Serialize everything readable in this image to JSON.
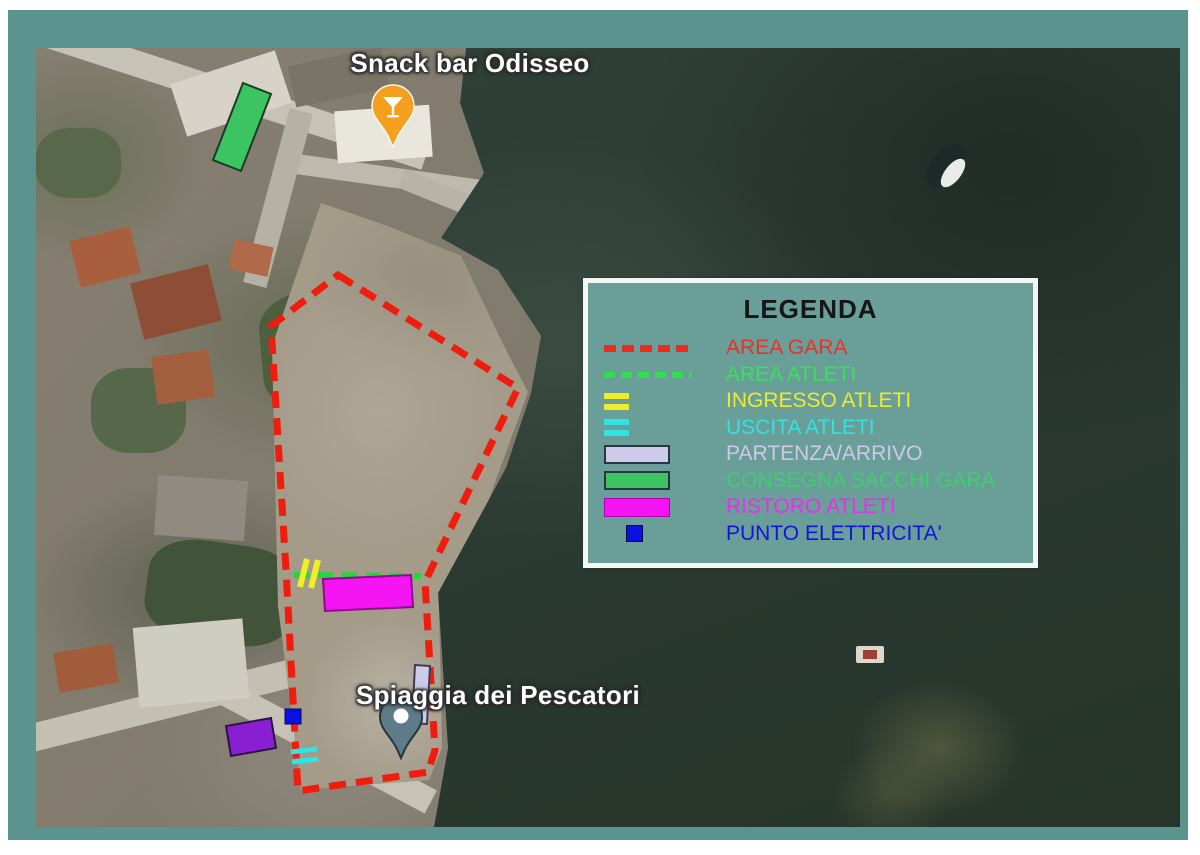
{
  "window": {
    "page_background": "#ffffff",
    "frame_color": "#5b938e"
  },
  "map": {
    "place_labels": [
      {
        "name": "snack-bar-label",
        "text": "Snack bar Odisseo"
      },
      {
        "name": "beach-label",
        "text": "Spiaggia dei Pescatori"
      }
    ],
    "pins": [
      {
        "name": "snack-bar-pin",
        "icon": "cocktail-glass",
        "color": "#f59f1e"
      },
      {
        "name": "beach-pin",
        "icon": "dot",
        "color": "#5d7b89"
      }
    ],
    "objects": [
      {
        "name": "boat",
        "color": "#e9ece6"
      },
      {
        "name": "mooring-float",
        "color": "#ddd8cc"
      }
    ],
    "overlays": {
      "area_gara": {
        "color": "#ee1d0e"
      },
      "area_atleti": {
        "color": "#25d53d"
      },
      "ingresso": {
        "color": "#f0ee28"
      },
      "uscita": {
        "color": "#2ee4e4"
      },
      "partenza": {
        "color": "#cdcaea"
      },
      "consegna": {
        "color": "#3dc462"
      },
      "ristoro": {
        "color": "#f414f4"
      },
      "elettricita": {
        "color": "#0b11e3"
      },
      "extra_purple": {
        "color": "#8a1fd2"
      }
    }
  },
  "legend": {
    "title": "LEGENDA",
    "background": "#6a9e99",
    "border_color": "#f3f6f2",
    "items": [
      {
        "label": "AREA GARA",
        "color": "#e63429",
        "swatch": "dash",
        "swatch_color": "#e92c1c"
      },
      {
        "label": "AREA ATLETI",
        "color": "#3ae05a",
        "swatch": "dash",
        "swatch_color": "#2ee04e"
      },
      {
        "label": "INGRESSO ATLETI",
        "color": "#edea2f",
        "swatch": "double-dash",
        "swatch_color": "#f0ee28"
      },
      {
        "label": "USCITA ATLETI",
        "color": "#31e2e2",
        "swatch": "double-dash",
        "swatch_color": "#2ee4e4"
      },
      {
        "label": "PARTENZA/ARRIVO",
        "color": "#cdcae9",
        "swatch": "rect",
        "swatch_color": "#cdcaea"
      },
      {
        "label": "CONSEGNA SACCHI GARA",
        "color": "#3ed06e",
        "swatch": "rect",
        "swatch_color": "#3dc462"
      },
      {
        "label": "RISTORO ATLETI",
        "color": "#ee2bee",
        "swatch": "rect",
        "swatch_color": "#f414f4"
      },
      {
        "label": "PUNTO ELETTRICITA'",
        "color": "#1414dc",
        "swatch": "square",
        "swatch_color": "#0b11e3"
      }
    ]
  }
}
